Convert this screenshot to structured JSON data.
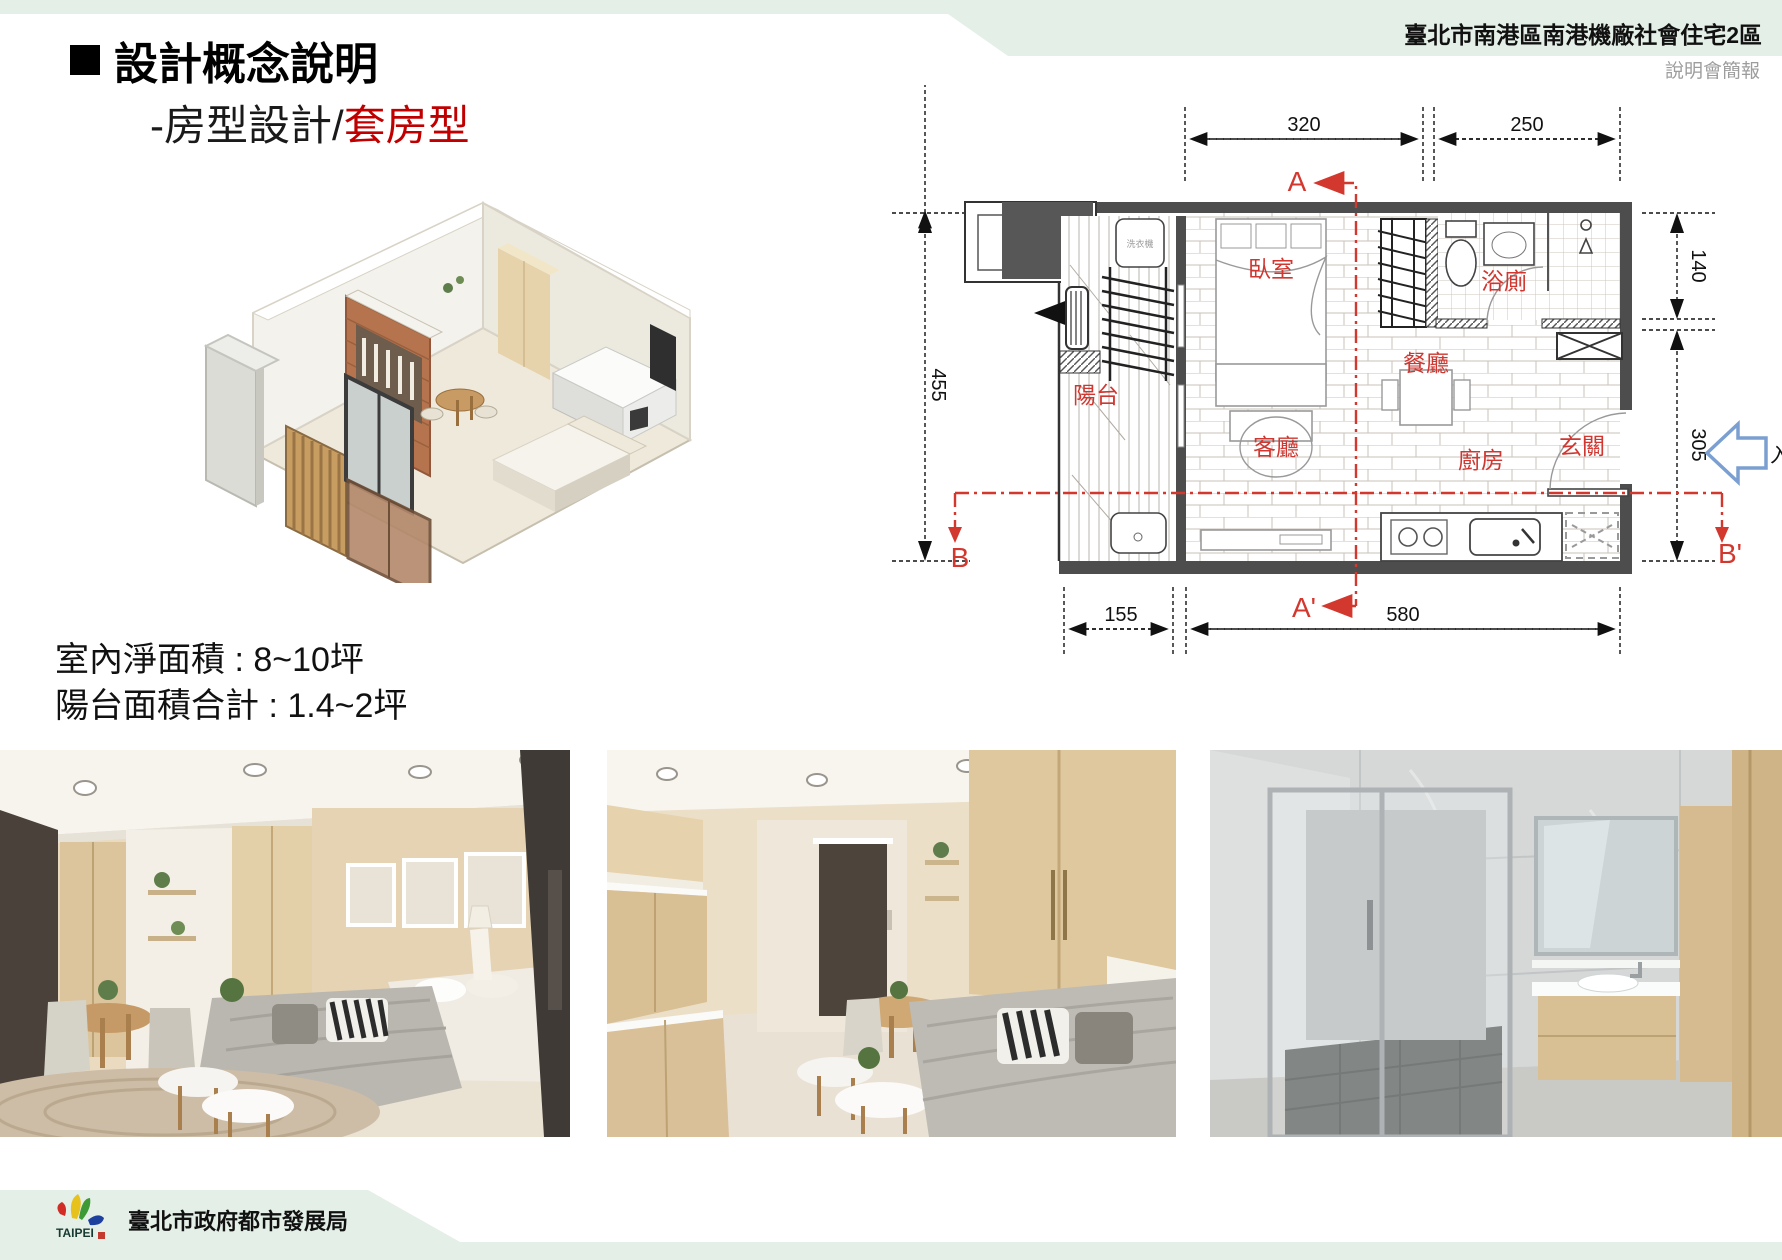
{
  "header": {
    "banner_title": "臺北市南港區南港機廠社會住宅2區",
    "banner_subtitle": "說明會簡報",
    "banner_color": "#e3efe7"
  },
  "title": {
    "main": "設計概念說明",
    "sub_prefix": "-房型設計/",
    "sub_highlight": "套房型",
    "highlight_color": "#c00000"
  },
  "area_info": {
    "line1": "室內淨面積 : 8~10坪",
    "line2": "陽台面積合計 : 1.4~2坪"
  },
  "floor_plan": {
    "rooms": {
      "bedroom": "臥室",
      "bathroom": "浴廁",
      "dining": "餐廳",
      "balcony": "陽台",
      "living": "客廳",
      "kitchen": "廚房",
      "entry": "玄關"
    },
    "dims": {
      "top_left": "320",
      "top_right": "250",
      "left": "455",
      "right_top": "140",
      "right_bottom": "305",
      "bottom_left": "155",
      "bottom_right": "580"
    },
    "sections": {
      "a": "A",
      "a_prime": "A'",
      "b": "B",
      "b_prime": "B'"
    },
    "entrance_label": "入口",
    "washer_label": "洗衣機",
    "colors": {
      "section_red": "#d3382f",
      "room_label_red": "#cf3730",
      "entrance_arrow_blue": "#7b9fd1",
      "wall_gray": "#4d4d4d"
    }
  },
  "footer": {
    "agency": "臺北市政府都市發展局",
    "logo_text": "TAIPEI"
  }
}
